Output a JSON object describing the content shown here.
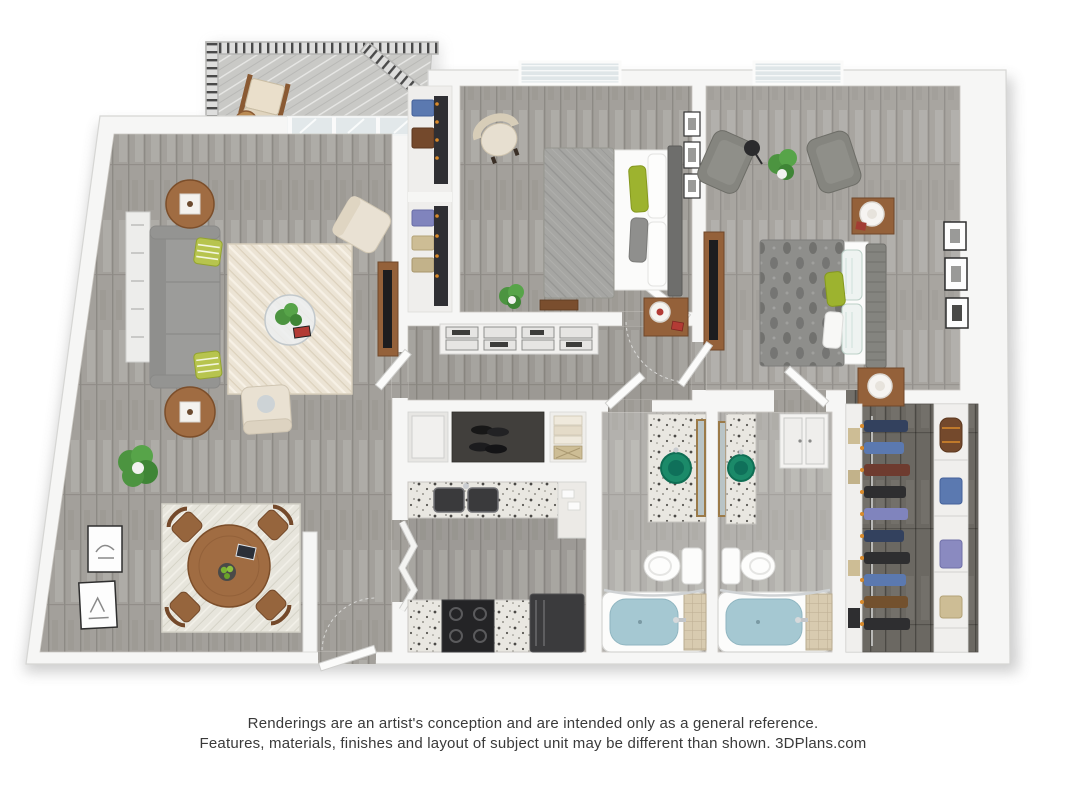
{
  "page": {
    "background": "#ffffff"
  },
  "disclaimer": {
    "line1": "Renderings are an artist's conception and are intended only as a general reference.",
    "line2": "Features, materials, finishes and layout of subject unit may be different than shown. 3DPlans.com"
  },
  "floorplan": {
    "description": "3D top-down rendering of a two-bedroom, two-bathroom apartment with balcony, walk-in closet, galley kitchen and combined living/dining room",
    "rooms": [
      "balcony",
      "living-room",
      "dining-area",
      "entry",
      "kitchen",
      "hallway",
      "bedroom-1",
      "bedroom-1-closet",
      "bedroom-2",
      "bathroom-1",
      "bathroom-2",
      "walk-in-closet"
    ],
    "colors": {
      "walls": "#f5f5f4",
      "wood_floor": "#a3a09b",
      "dark_closet_floor": "#6b6862",
      "rug_cream": "#ece4d5",
      "sofa_gray": "#9c9c9a",
      "accent_green_pillow": "#9db32f",
      "plant_green": "#4c9440",
      "wood_furniture": "#94613a",
      "bathtub_water": "#a5c8d2",
      "vessel_sink_green": "#1b8a69",
      "railing_dark": "#4a4a4a"
    }
  }
}
